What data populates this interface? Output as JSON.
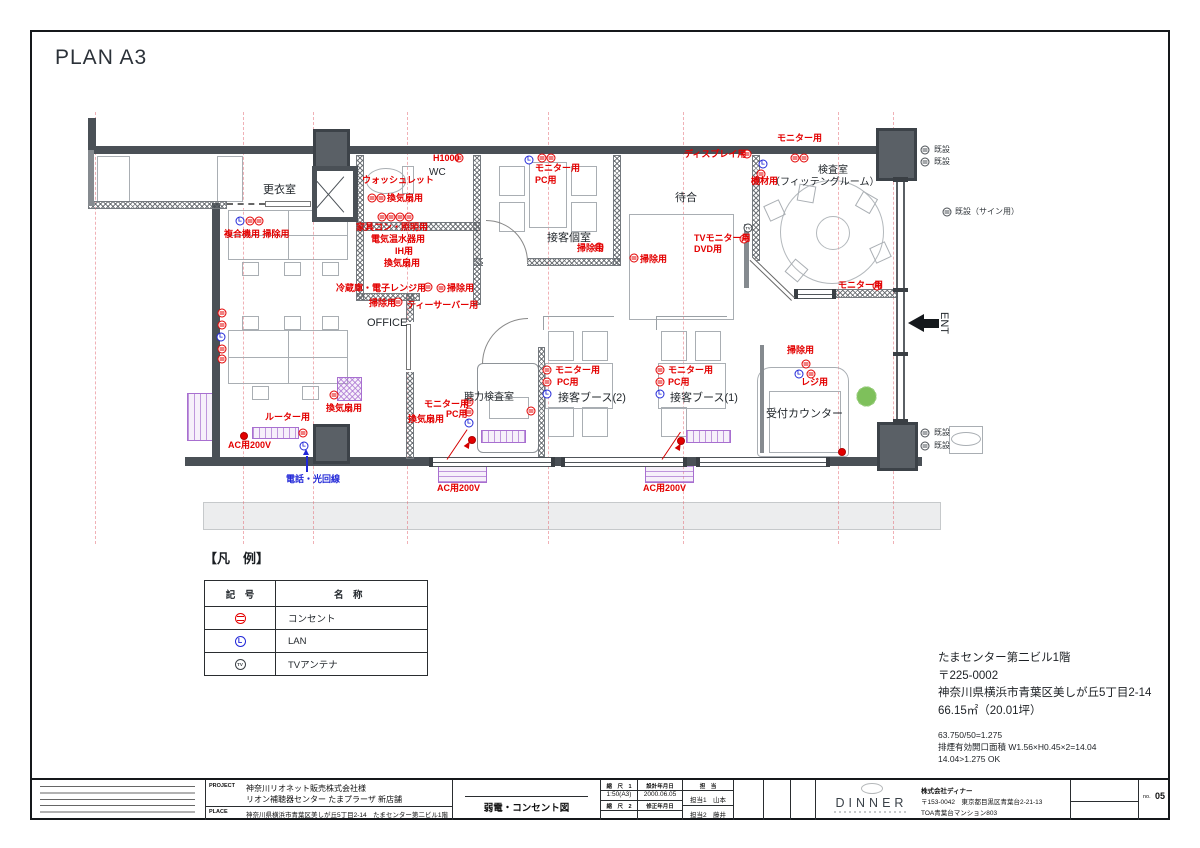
{
  "page": {
    "title": "PLAN A3"
  },
  "plan": {
    "rooms": [
      {
        "t": "更衣室",
        "x": 263,
        "y": 181,
        "fs": 11
      },
      {
        "t": "WC",
        "x": 429,
        "y": 167,
        "fs": 10
      },
      {
        "t": "接客個室",
        "x": 547,
        "y": 229,
        "fs": 11
      },
      {
        "t": "待合",
        "x": 675,
        "y": 189,
        "fs": 11
      },
      {
        "t": "検査室",
        "x": 818,
        "y": 161,
        "fs": 10
      },
      {
        "t": "（フィッテングルーム）",
        "x": 770,
        "y": 173,
        "fs": 10
      },
      {
        "t": "OFFICE",
        "x": 367,
        "y": 317,
        "fs": 11
      },
      {
        "t": "聴力検査室",
        "x": 464,
        "y": 388,
        "fs": 10
      },
      {
        "t": "接客ブース(2)",
        "x": 558,
        "y": 389,
        "fs": 11
      },
      {
        "t": "接客ブース(1)",
        "x": 670,
        "y": 389,
        "fs": 11
      },
      {
        "t": "受付カウンター",
        "x": 766,
        "y": 405,
        "fs": 11
      },
      {
        "t": "ENT",
        "x": 950,
        "y": 312,
        "fs": 11,
        "rot": 90
      }
    ],
    "labels": [
      {
        "t": "ウォッシュレット",
        "x": 362,
        "y": 176,
        "c": "r"
      },
      {
        "t": "H1000",
        "x": 433,
        "y": 154,
        "c": "r"
      },
      {
        "t": "換気扇用",
        "x": 387,
        "y": 194,
        "c": "r"
      },
      {
        "t": "家具コン・照明用",
        "x": 356,
        "y": 223,
        "c": "r"
      },
      {
        "t": "電気温水器用",
        "x": 371,
        "y": 235,
        "c": "r"
      },
      {
        "t": "IH用",
        "x": 395,
        "y": 247,
        "c": "r"
      },
      {
        "t": "換気扇用",
        "x": 384,
        "y": 259,
        "c": "r"
      },
      {
        "t": "複合機用 掃除用",
        "x": 224,
        "y": 230,
        "c": "r"
      },
      {
        "t": "冷蔵庫・電子レンジ用",
        "x": 336,
        "y": 284,
        "c": "r"
      },
      {
        "t": "掃除用",
        "x": 447,
        "y": 284,
        "c": "r"
      },
      {
        "t": "掃除用",
        "x": 369,
        "y": 299,
        "c": "r"
      },
      {
        "t": "ティーサーバー用",
        "x": 407,
        "y": 301,
        "c": "r"
      },
      {
        "t": "モニター用",
        "x": 535,
        "y": 164,
        "c": "r"
      },
      {
        "t": "PC用",
        "x": 535,
        "y": 176,
        "c": "r"
      },
      {
        "t": "掃除用",
        "x": 577,
        "y": 244,
        "c": "r"
      },
      {
        "t": "掃除用",
        "x": 640,
        "y": 255,
        "c": "r"
      },
      {
        "t": "ディスプレイ用",
        "x": 684,
        "y": 150,
        "c": "r"
      },
      {
        "t": "モニター用",
        "x": 777,
        "y": 134,
        "c": "r"
      },
      {
        "t": "機材用",
        "x": 751,
        "y": 177,
        "c": "r"
      },
      {
        "t": "TVモニター用",
        "x": 694,
        "y": 234,
        "c": "r"
      },
      {
        "t": "DVD用",
        "x": 694,
        "y": 245,
        "c": "r"
      },
      {
        "t": "モニター用",
        "x": 838,
        "y": 281,
        "c": "r"
      },
      {
        "t": "モニター用",
        "x": 424,
        "y": 400,
        "c": "r"
      },
      {
        "t": "PC用",
        "x": 446,
        "y": 410,
        "c": "r"
      },
      {
        "t": "換気扇用",
        "x": 408,
        "y": 415,
        "c": "r"
      },
      {
        "t": "換気扇用",
        "x": 326,
        "y": 404,
        "c": "r"
      },
      {
        "t": "ルーター用",
        "x": 265,
        "y": 413,
        "c": "r"
      },
      {
        "t": "AC用200V",
        "x": 228,
        "y": 441,
        "c": "r"
      },
      {
        "t": "AC用200V",
        "x": 437,
        "y": 484,
        "c": "r"
      },
      {
        "t": "AC用200V",
        "x": 643,
        "y": 484,
        "c": "r"
      },
      {
        "t": "モニター用",
        "x": 555,
        "y": 366,
        "c": "r"
      },
      {
        "t": "PC用",
        "x": 557,
        "y": 378,
        "c": "r"
      },
      {
        "t": "モニター用",
        "x": 668,
        "y": 366,
        "c": "r"
      },
      {
        "t": "PC用",
        "x": 668,
        "y": 378,
        "c": "r"
      },
      {
        "t": "掃除用",
        "x": 787,
        "y": 346,
        "c": "r"
      },
      {
        "t": "レジ用",
        "x": 801,
        "y": 378,
        "c": "r"
      },
      {
        "t": "電話・光回線",
        "x": 286,
        "y": 475,
        "c": "b"
      },
      {
        "t": "既設",
        "x": 934,
        "y": 146,
        "c": "k"
      },
      {
        "t": "既設",
        "x": 934,
        "y": 158,
        "c": "k"
      },
      {
        "t": "既設（サイン用）",
        "x": 955,
        "y": 208,
        "c": "k"
      },
      {
        "t": "既設",
        "x": 934,
        "y": 429,
        "c": "k"
      },
      {
        "t": "既設",
        "x": 934,
        "y": 442,
        "c": "k"
      }
    ],
    "symbols": [
      {
        "k": "o",
        "x": 459,
        "y": 158
      },
      {
        "k": "o",
        "x": 372,
        "y": 198
      },
      {
        "k": "o",
        "x": 381,
        "y": 198
      },
      {
        "k": "o",
        "x": 382,
        "y": 217
      },
      {
        "k": "o",
        "x": 391,
        "y": 217
      },
      {
        "k": "o",
        "x": 400,
        "y": 217
      },
      {
        "k": "o",
        "x": 409,
        "y": 217
      },
      {
        "k": "l",
        "x": 240,
        "y": 221
      },
      {
        "k": "o",
        "x": 250,
        "y": 221
      },
      {
        "k": "o",
        "x": 259,
        "y": 221
      },
      {
        "k": "o",
        "x": 428,
        "y": 287
      },
      {
        "k": "o",
        "x": 441,
        "y": 288
      },
      {
        "k": "o",
        "x": 398,
        "y": 302
      },
      {
        "k": "l",
        "x": 529,
        "y": 160
      },
      {
        "k": "o",
        "x": 542,
        "y": 158
      },
      {
        "k": "o",
        "x": 551,
        "y": 158
      },
      {
        "k": "o",
        "x": 599,
        "y": 247
      },
      {
        "k": "o",
        "x": 634,
        "y": 258
      },
      {
        "k": "o",
        "x": 747,
        "y": 154
      },
      {
        "k": "o",
        "x": 795,
        "y": 158
      },
      {
        "k": "o",
        "x": 804,
        "y": 158
      },
      {
        "k": "l",
        "x": 763,
        "y": 164
      },
      {
        "k": "o",
        "x": 761,
        "y": 174
      },
      {
        "k": "t",
        "x": 748,
        "y": 228
      },
      {
        "k": "o",
        "x": 744,
        "y": 239
      },
      {
        "k": "o",
        "x": 877,
        "y": 286
      },
      {
        "k": "o",
        "x": 806,
        "y": 364
      },
      {
        "k": "l",
        "x": 799,
        "y": 374
      },
      {
        "k": "o",
        "x": 811,
        "y": 374
      },
      {
        "k": "o",
        "x": 547,
        "y": 370
      },
      {
        "k": "o",
        "x": 547,
        "y": 382
      },
      {
        "k": "l",
        "x": 547,
        "y": 394
      },
      {
        "k": "o",
        "x": 660,
        "y": 370
      },
      {
        "k": "o",
        "x": 660,
        "y": 382
      },
      {
        "k": "l",
        "x": 660,
        "y": 394
      },
      {
        "k": "o",
        "x": 531,
        "y": 411
      },
      {
        "k": "o",
        "x": 469,
        "y": 402
      },
      {
        "k": "o",
        "x": 469,
        "y": 412
      },
      {
        "k": "l",
        "x": 469,
        "y": 423
      },
      {
        "k": "o",
        "x": 334,
        "y": 395
      },
      {
        "k": "o",
        "x": 222,
        "y": 313
      },
      {
        "k": "o",
        "x": 222,
        "y": 325
      },
      {
        "k": "l",
        "x": 221,
        "y": 337
      },
      {
        "k": "o",
        "x": 222,
        "y": 349
      },
      {
        "k": "o",
        "x": 222,
        "y": 359
      },
      {
        "k": "o",
        "x": 303,
        "y": 433
      },
      {
        "k": "l",
        "x": 304,
        "y": 446
      },
      {
        "k": "e",
        "x": 925,
        "y": 150
      },
      {
        "k": "e",
        "x": 925,
        "y": 162
      },
      {
        "k": "e",
        "x": 947,
        "y": 212
      },
      {
        "k": "e",
        "x": 925,
        "y": 433
      },
      {
        "k": "e",
        "x": 925,
        "y": 446
      },
      {
        "k": "d",
        "x": 244,
        "y": 436
      },
      {
        "k": "d",
        "x": 472,
        "y": 440
      },
      {
        "k": "d",
        "x": 681,
        "y": 441
      },
      {
        "k": "d",
        "x": 842,
        "y": 452
      }
    ]
  },
  "legend": {
    "title": "【凡　例】",
    "header": {
      "symbol": "記　号",
      "name": "名　称"
    },
    "rows": [
      {
        "sym": "outlet",
        "name": "コンセント"
      },
      {
        "sym": "lan",
        "name": "LAN"
      },
      {
        "sym": "tv-antenna",
        "name": "TVアンテナ"
      }
    ]
  },
  "site_notes": {
    "l1": "たまセンター第二ビル1階",
    "l2": "〒225-0002",
    "l3": "神奈川県横浜市青葉区美しが丘5丁目2-14",
    "l4": "66.15㎡（20.01坪）",
    "s1": "63.750/50=1.275",
    "s2": "排煙有効開口面積 W1.56×H0.45×2=14.04",
    "s3": "14.04>1.275 OK"
  },
  "titleblock": {
    "project_label": "PROJECT",
    "place_label": "PLACE",
    "project1": "神奈川リオネット販売株式会社様",
    "project2": "リオン補聴器センター たまプラーザ 新店舗",
    "place": "神奈川県横浜市青葉区美しが丘5丁目2-14　たまセンター第二ビル1階",
    "drawing_title": "弱電・コンセント図",
    "scale1_label": "縮　尺　1",
    "scale1": "1:50(A3)",
    "scale2_label": "縮　尺　2",
    "scale2": "",
    "date1_label": "設計年月日",
    "date1": "2000.06.05",
    "date2_label": "修正年月日",
    "date2": "",
    "staff_label": "担　当",
    "staff1": "担当1　山本",
    "staff2": "担当2　藤井",
    "logo": "DINNER",
    "company1": "株式会社ディナー",
    "company2": "〒153-0042　東京都目黒区青葉台2-21-13",
    "company3": "TOA青葉台マンション803",
    "no_label": "no.",
    "no_value": "05"
  }
}
